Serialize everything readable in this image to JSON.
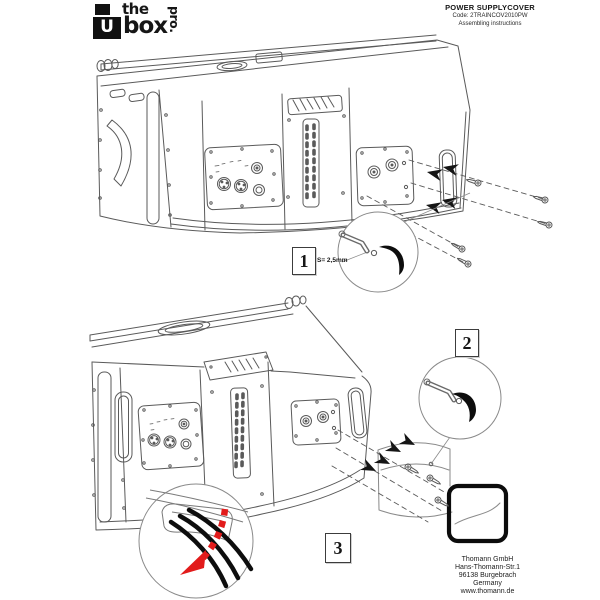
{
  "logo": {
    "the": "the",
    "box": "box",
    "pro": "pro.",
    "u_glyph": "U"
  },
  "header": {
    "title": "POWER SUPPLYCOVER",
    "code": "Code: 2TRAINCOV2010PW",
    "subtitle": "Assembling instructions"
  },
  "steps": {
    "step1": {
      "number": "1",
      "tool_note": "S= 2,5mm"
    },
    "step2": {
      "number": "2"
    },
    "step3": {
      "number": "3"
    }
  },
  "footer": {
    "company": "Thomann GmbH",
    "street": "Hans-Thomann-Str.1",
    "city": "96138 Burgebrach",
    "country": "Germany",
    "website": "www.thomann.de"
  },
  "colors": {
    "paper": "#ffffff",
    "line_art": "#5a5a5a",
    "ink": "#161616",
    "highlight_red": "#e21b1b",
    "cover_outline": "#0c0c0c"
  }
}
